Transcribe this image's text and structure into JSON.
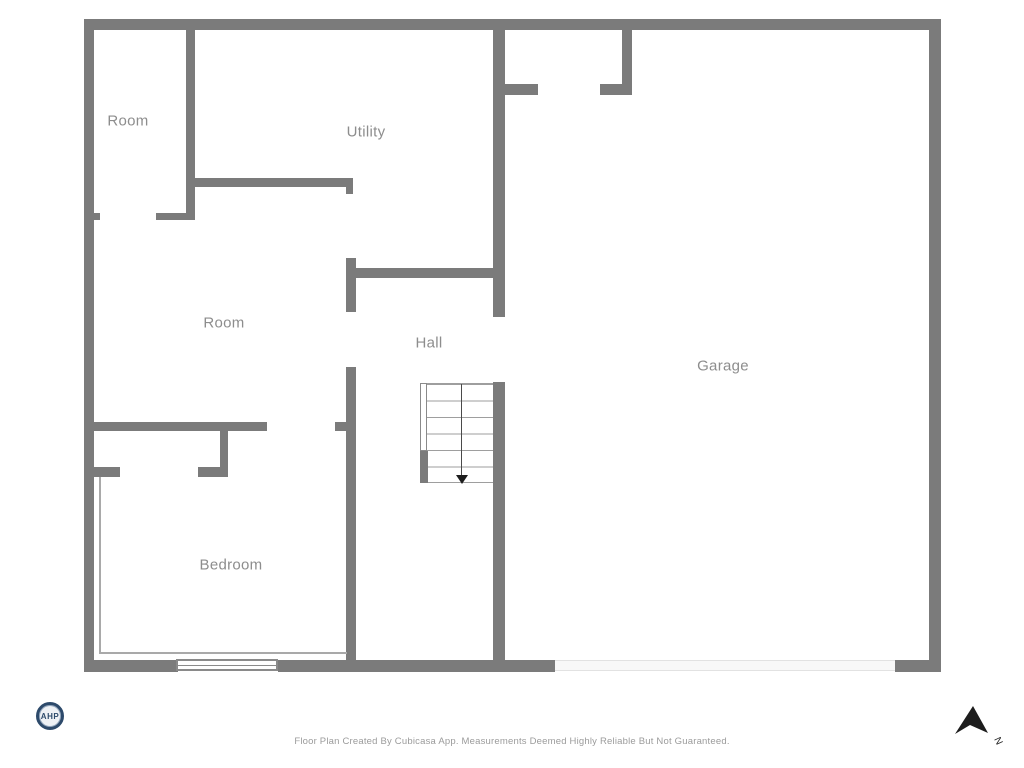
{
  "floorplan": {
    "rooms": [
      {
        "label": "Room"
      },
      {
        "label": "Utility"
      },
      {
        "label": "Room"
      },
      {
        "label": "Hall"
      },
      {
        "label": "Garage"
      },
      {
        "label": "Bedroom"
      }
    ]
  },
  "stairs": {
    "direction": "down"
  },
  "compass": {
    "label": "N"
  },
  "logo": {
    "text": "AHP"
  },
  "footer": {
    "disclaimer": "Floor Plan Created By Cubicasa App. Measurements Deemed Highly Reliable But Not Guaranteed."
  },
  "colors": {
    "wall": "#7b7b7b",
    "room_label": "#8d8d8d",
    "thin_line": "#a9a9a9",
    "footer_text": "#9b9b9b",
    "compass_arrow": "#1d1d1d",
    "logo_navy": "#2d4a6b",
    "background": "#ffffff"
  }
}
